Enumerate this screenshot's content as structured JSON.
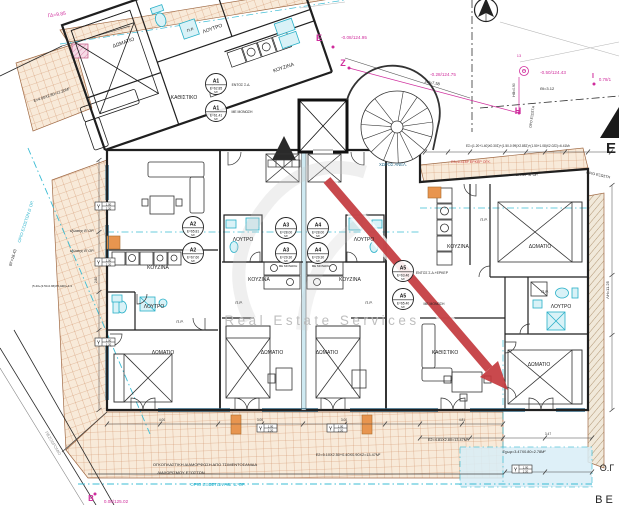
{
  "watermark": {
    "text": "Real Estate Services",
    "arrow_color": "#c43a3e",
    "text_color": "#b8b8b8"
  },
  "colors": {
    "wall": "#1f1f1f",
    "tile_line": "#cf8f66",
    "tile_bg": "#f8ead9",
    "cyan": "#2ab3cc",
    "magenta": "#cf2c9c",
    "dim": "#333333",
    "orange": "#e8954f"
  },
  "labels": {
    "rooms": [
      {
        "t": "ΔΩΜΑΤΙΟ",
        "x": 124,
        "y": 44,
        "r": -19,
        "n": "room-label-bedroom"
      },
      {
        "t": "Π.Ρ.",
        "x": 191,
        "y": 31,
        "r": -19,
        "s": 4,
        "n": "room-label-pr"
      },
      {
        "t": "ΛΟΥΤΡΟ",
        "x": 213,
        "y": 30,
        "r": -19,
        "n": "room-label-bath"
      },
      {
        "t": "ΚΟΥΖΙΝΑ",
        "x": 284,
        "y": 69,
        "r": -19,
        "n": "room-label-kitchen"
      },
      {
        "t": "ΚΑΘΙΣΤΙΚΟ",
        "x": 184,
        "y": 99,
        "n": "room-label-living"
      },
      {
        "t": "ΚΟΥΖΙΝΑ",
        "x": 158,
        "y": 269,
        "n": "room-label-kitchen"
      },
      {
        "t": "ΛΟΥΤΡΟ",
        "x": 154,
        "y": 308,
        "n": "room-label-bath"
      },
      {
        "t": "Π.Ρ.",
        "x": 180,
        "y": 323,
        "s": 4,
        "n": "room-label-pr"
      },
      {
        "t": "ΔΩΜΑΤΙΟ",
        "x": 163,
        "y": 354,
        "n": "room-label-bedroom"
      },
      {
        "t": "ΛΟΥΤΡΟ",
        "x": 243,
        "y": 241,
        "n": "room-label-bath"
      },
      {
        "t": "ΚΟΥΖΙΝΑ",
        "x": 259,
        "y": 281,
        "n": "room-label-kitchen"
      },
      {
        "t": "Π.Ρ.",
        "x": 239,
        "y": 304,
        "s": 4,
        "n": "room-label-pr"
      },
      {
        "t": "ΔΩΜΑΤΙΟ",
        "x": 272,
        "y": 354,
        "n": "room-label-bedroom"
      },
      {
        "t": "ΛΟΥΤΡΟ",
        "x": 364,
        "y": 241,
        "n": "room-label-bath"
      },
      {
        "t": "ΚΟΥΖΙΝΑ",
        "x": 350,
        "y": 281,
        "n": "room-label-kitchen"
      },
      {
        "t": "Π.Ρ.",
        "x": 369,
        "y": 304,
        "s": 4,
        "n": "room-label-pr"
      },
      {
        "t": "ΔΩΜΑΤΙΟ",
        "x": 327,
        "y": 354,
        "n": "room-label-bedroom"
      },
      {
        "t": "ΚΟΥΖΙΝΑ",
        "x": 458,
        "y": 248,
        "n": "room-label-kitchen"
      },
      {
        "t": "ΔΩΜΑΤΙΟ",
        "x": 540,
        "y": 248,
        "n": "room-label-bedroom"
      },
      {
        "t": "Π.Ρ.",
        "x": 484,
        "y": 221,
        "s": 4,
        "n": "room-label-pr"
      },
      {
        "t": "Π.Ρ.",
        "x": 545,
        "y": 293,
        "s": 4,
        "n": "room-label-pr"
      },
      {
        "t": "ΛΟΥΤΡΟ",
        "x": 561,
        "y": 308,
        "n": "room-label-bath"
      },
      {
        "t": "ΚΑΘΙΣΤΙΚΟ",
        "x": 445,
        "y": 354,
        "n": "room-label-living"
      },
      {
        "t": "ΔΩΜΑΤΙΟ",
        "x": 539,
        "y": 366,
        "n": "room-label-bedroom"
      },
      {
        "t": "ΧΩΡΟΣ ΑΝΕΛ.",
        "x": 393,
        "y": 166,
        "s": 4.2,
        "c": "#2b6e8c",
        "n": "room-label-elevator-area"
      }
    ],
    "annotations": [
      {
        "t": "ΕΝΤΟΣ Σ.Δ.",
        "x": 241,
        "y": 86,
        "s": 3.4
      },
      {
        "t": "ΜΕ ΜΟΝΩΣΗ",
        "x": 242,
        "y": 113,
        "s": 3.4
      },
      {
        "t": "ΜΕ ΜΟΝΩΣΗ",
        "x": 288,
        "y": 267,
        "s": 3
      },
      {
        "t": "ΜΕ ΜΟΝΩΣΗ",
        "x": 321,
        "y": 267,
        "s": 3
      },
      {
        "t": "ΕΝΤΟΣ Σ.Δ.+ΕΡΚΕΡ",
        "x": 432,
        "y": 274,
        "s": 3.4
      },
      {
        "t": "ΜΕ ΜΟΝΩΣΗ",
        "x": 434,
        "y": 305,
        "s": 3.4
      },
      {
        "t": "εξώστης Β' ΟΡ.",
        "x": 82,
        "y": 232,
        "s": 3.6,
        "i": 1
      },
      {
        "t": "εξώστης Β' ΟΡ.",
        "x": 82,
        "y": 252,
        "s": 3.6,
        "i": 1
      },
      {
        "t": "Ε=4.00Χ2.80=11.20Μ²",
        "x": 52,
        "y": 96,
        "r": -19,
        "s": 3.8
      },
      {
        "t": "Ε2=5.10Χ2.50+0.40Χ0.90Χ2=13.47Μ²",
        "x": 348,
        "y": 456,
        "s": 3.8
      },
      {
        "t": "Ε2=4.81Χ2.80=13.47Μ²",
        "x": 448,
        "y": 441,
        "s": 3.8
      },
      {
        "t": "Εχωρ=3.47Χ0.80=2.78Μ²",
        "x": 524,
        "y": 453,
        "s": 3.8
      },
      {
        "t": "ΟΓΚΟΠΛΑΣΤΙΚΗ ΔΙΑΜΟΡΦΩΣΗ ΑΠΟ ΤΣΙΜΕΝΤΟΣΑΝΙΔΑ",
        "x": 205,
        "y": 466,
        "s": 4
      },
      {
        "t": "ΔΙΑΧΩΡΙΣΜΟΥ ΕΞΩΣΤΩΝ",
        "x": 181,
        "y": 474,
        "s": 4
      },
      {
        "t": "ΕΣ=(1.20+1.40)Χ0.30Σ)+(1.50-0.99)Χ2.85Σ)+(1.50+1.08)Χ2.02Σ)=6.41Μ²",
        "x": 518,
        "y": 147,
        "s": 3.2
      },
      {
        "t": "Ε3=6.41Μ² ΕΡΚΕΡ ΟΓΚ.",
        "x": 471,
        "y": 163,
        "s": 3.6,
        "c": "#cc3b3b"
      },
      {
        "t": "ΕΡΚΕΡ Β' ΟΡ.",
        "x": 527,
        "y": 176,
        "s": 3.6
      },
      {
        "t": "ΟΡΙΟ ΕΞΩΣΤΗ",
        "x": 598,
        "y": 176,
        "r": 12,
        "s": 3.6
      },
      {
        "t": "ΘΙ=3.12",
        "x": 547,
        "y": 90,
        "s": 4
      },
      {
        "t": "ΖΗ=7.58",
        "x": 432,
        "y": 84,
        "r": 10,
        "s": 4
      },
      {
        "t": "ΗΘ=0.90",
        "x": 515,
        "y": 90,
        "r": -90,
        "s": 3.4
      },
      {
        "t": "ΟΡΟ ΕΞΩΣΤΗ",
        "x": 533,
        "y": 117,
        "r": -82,
        "s": 3.4
      },
      {
        "t": "ΛΗ=11.25",
        "x": 609,
        "y": 290,
        "r": -90,
        "s": 4
      },
      {
        "t": "ΒΓ=18.43",
        "x": 14,
        "y": 258,
        "r": -73,
        "s": 4
      },
      {
        "t": "ΠΕΖΟΔΡΟΜΙΟ",
        "x": 52,
        "y": 444,
        "r": 59,
        "s": 4,
        "c": "#8a8a8a"
      },
      {
        "t": "(5.40+(3.50-0.96)Χ5.44Σ)+4.3",
        "x": 52,
        "y": 287,
        "s": 3
      },
      {
        "t": "Ο.Γ",
        "x": 607,
        "y": 471,
        "s": 9
      },
      {
        "t": "Β Ε",
        "x": 604,
        "y": 503,
        "s": 11
      },
      {
        "t": "Ε",
        "x": 611,
        "y": 153,
        "s": 15,
        "w": 700
      },
      {
        "t": "ΟΡΙΟ ΕΞΩΣΤΩΝ Α&Γ Δ' ΟΡ.",
        "x": 218,
        "y": 486,
        "s": 4.4,
        "c": "#2ab3cc"
      },
      {
        "t": "ΟΡΙΟ ΕΞΩΣΤΩΝ Δ' ΟΡ.",
        "x": 27,
        "y": 222,
        "r": -72,
        "s": 4.2,
        "c": "#2ab3cc"
      }
    ],
    "survey": [
      {
        "t": "ΓΔ≈9.85",
        "x": 57,
        "y": 16,
        "r": -8,
        "s": 5
      },
      {
        "t": "Ε",
        "x": 319,
        "y": 41,
        "s": 9,
        "w": 700
      },
      {
        "t": "-0.08/124.95",
        "x": 354,
        "y": 39,
        "s": 4.6
      },
      {
        "t": "Ζ",
        "x": 343,
        "y": 66,
        "s": 9,
        "w": 700
      },
      {
        "t": "-0.28/124.75",
        "x": 443,
        "y": 76,
        "s": 4.6
      },
      {
        "t": "Θ",
        "x": 524,
        "y": 73,
        "s": 5.5,
        "w": 700
      },
      {
        "t": "-0.50/124.43",
        "x": 553,
        "y": 74,
        "s": 4.6
      },
      {
        "t": "13",
        "x": 519,
        "y": 57,
        "s": 4
      },
      {
        "t": "Η",
        "x": 518,
        "y": 114,
        "s": 9,
        "w": 700
      },
      {
        "t": "Ι",
        "x": 593,
        "y": 78,
        "s": 7,
        "w": 700
      },
      {
        "t": "0.78/1",
        "x": 605,
        "y": 81,
        "s": 4.4
      },
      {
        "t": "Β",
        "x": 91,
        "y": 501,
        "s": 8,
        "w": 700
      },
      {
        "t": "0.08/125.02",
        "x": 116,
        "y": 503,
        "s": 4.6
      }
    ],
    "dimensions": [
      {
        "t": "4.00",
        "x": 162,
        "y": 421
      },
      {
        "t": "3.00",
        "x": 260,
        "y": 421
      },
      {
        "t": "3.00",
        "x": 344,
        "y": 421
      },
      {
        "t": "4.81",
        "x": 462,
        "y": 421
      },
      {
        "t": "3.47",
        "x": 548,
        "y": 435
      },
      {
        "t": "2.80",
        "x": 97,
        "y": 280,
        "r": -90
      }
    ]
  },
  "apartment_stamps": [
    {
      "id": "Α1",
      "area": "Ε=62.85",
      "unit": "Μ²",
      "x": 216,
      "y": 84
    },
    {
      "id": "Α1",
      "area": "Ε=61.41",
      "unit": "Μ²",
      "x": 216,
      "y": 111
    },
    {
      "id": "Α2",
      "area": "Ε=65.81",
      "unit": "Μ²",
      "x": 193,
      "y": 227
    },
    {
      "id": "Α2",
      "area": "Ε=67.60",
      "unit": "Μ²",
      "x": 193,
      "y": 253
    },
    {
      "id": "Α3",
      "area": "Ε=28.00",
      "unit": "Μ²",
      "x": 286,
      "y": 228
    },
    {
      "id": "Α4",
      "area": "Ε=28.00",
      "unit": "Μ²",
      "x": 318,
      "y": 228
    },
    {
      "id": "Α3",
      "area": "Ε=29.30",
      "unit": "Μ²",
      "x": 286,
      "y": 253
    },
    {
      "id": "Α4",
      "area": "Ε=29.30",
      "unit": "Μ²",
      "x": 318,
      "y": 253
    },
    {
      "id": "Α5",
      "area": "Ε=63.46",
      "unit": "Μ²",
      "x": 403,
      "y": 271
    },
    {
      "id": "Α5",
      "area": "Ε=65.40",
      "unit": "Μ²",
      "x": 403,
      "y": 299
    }
  ],
  "window_stamps": {
    "letter": "Υ",
    "w": "1.00",
    "h": "2.20",
    "positions": [
      [
        95,
        202
      ],
      [
        95,
        258
      ],
      [
        95,
        338
      ],
      [
        257,
        424
      ],
      [
        327,
        424
      ],
      [
        512,
        465
      ]
    ]
  }
}
